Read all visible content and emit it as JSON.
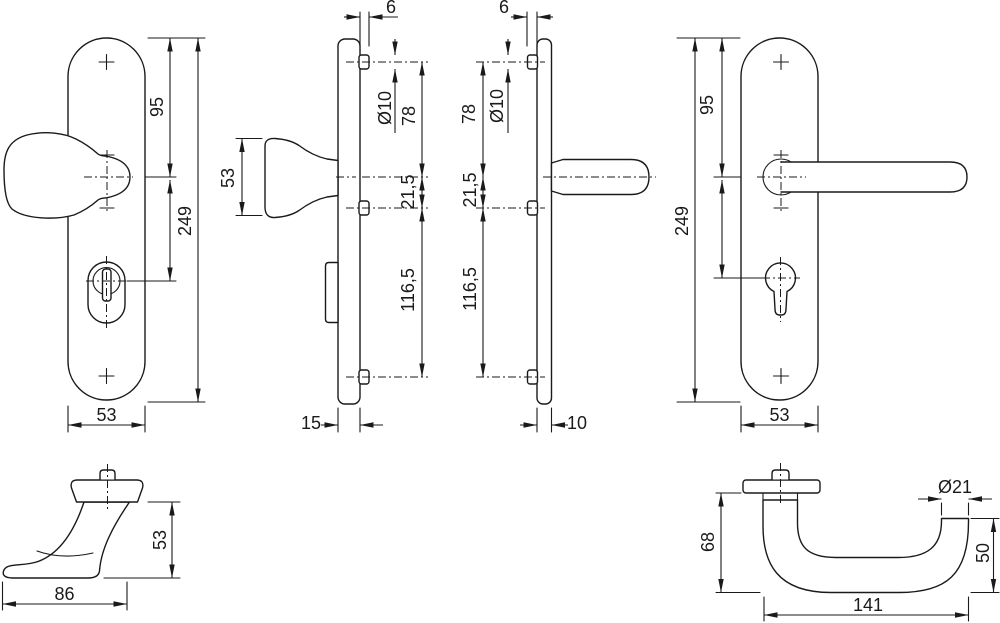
{
  "colors": {
    "line": "#1a1a1a",
    "background": "#ffffff"
  },
  "drawing_type": "door-security-fitting technical drawing, six orthographic views",
  "dims": {
    "ext_front": {
      "d95": "95",
      "d249": "249",
      "d53": "53"
    },
    "ext_side": {
      "d6": "6",
      "dia10": "Ø10",
      "d78": "78",
      "d53_knob": "53",
      "d21_5": "21,5",
      "d116_5": "116,5",
      "d15": "15"
    },
    "int_side": {
      "d6": "6",
      "dia10": "Ø10",
      "d78": "78",
      "d21_5": "21,5",
      "d116_5": "116,5",
      "d10": "10"
    },
    "int_front": {
      "d95": "95",
      "d249": "249",
      "d53": "53"
    },
    "knob_profile": {
      "d53": "53",
      "d86": "86"
    },
    "lever_profile": {
      "d68": "68",
      "dia21": "Ø21",
      "d50": "50",
      "d141": "141"
    }
  }
}
